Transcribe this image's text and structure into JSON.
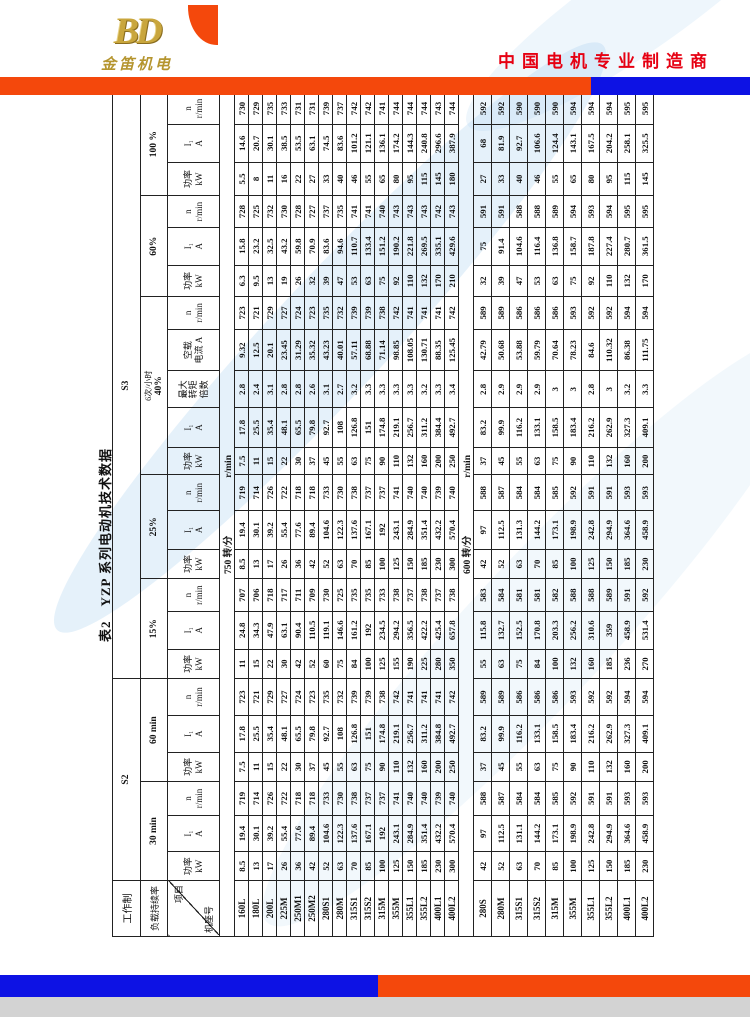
{
  "header": {
    "logo_monogram": "BD",
    "logo_text": "金笛机电",
    "slogan": "中国电机专业制造商"
  },
  "title": "表2　YZP 系列电动机技术数据",
  "table": {
    "work_system_label": "工作制",
    "duty_rate_label": "负载持续率",
    "corner": {
      "top": "项目",
      "bottom": "机座号"
    },
    "s2_label": "S2",
    "s3_label": "S3",
    "groups": [
      {
        "duty": [
          "30 min"
        ],
        "cols": [
          [
            "功率",
            "kW"
          ],
          [
            "I₁",
            "A"
          ],
          [
            "n",
            "r/min"
          ]
        ]
      },
      {
        "duty": [
          "60 min"
        ],
        "cols": [
          [
            "功率",
            "kW"
          ],
          [
            "I₁",
            "A"
          ],
          [
            "n",
            "r/min"
          ]
        ]
      },
      {
        "duty": [
          "15%"
        ],
        "cols": [
          [
            "功率",
            "kW"
          ],
          [
            "I₁",
            "A"
          ],
          [
            "n",
            "r/min"
          ]
        ]
      },
      {
        "duty": [
          "25%"
        ],
        "cols": [
          [
            "功率",
            "kW"
          ],
          [
            "I₁",
            "A"
          ],
          [
            "n",
            "r/min"
          ]
        ]
      },
      {
        "duty": [
          "6次/小时",
          "40%"
        ],
        "cols": [
          [
            "功率",
            "kW"
          ],
          [
            "I₁",
            "A"
          ],
          [
            "最大",
            "转矩",
            "倍数"
          ],
          [
            "空载",
            "电流 A"
          ],
          [
            "n",
            "r/min"
          ]
        ]
      },
      {
        "duty": [
          "60%"
        ],
        "cols": [
          [
            "功率",
            "kW"
          ],
          [
            "I₁",
            "A"
          ],
          [
            "n",
            "r/min"
          ]
        ]
      },
      {
        "duty": [
          "100 %"
        ],
        "cols": [
          [
            "功率",
            "kW"
          ],
          [
            "I₁",
            "A"
          ],
          [
            "n",
            "r/min"
          ]
        ]
      }
    ],
    "sections": [
      {
        "speed_label": "750 转/分",
        "unit": "r/min",
        "rows": [
          {
            "model": "160L",
            "v": [
              "8.5",
              "19.4",
              "719",
              "7.5",
              "17.8",
              "723",
              "11",
              "24.8",
              "707",
              "8.5",
              "19.4",
              "719",
              "7.5",
              "17.8",
              "2.8",
              "9.32",
              "723",
              "6.3",
              "15.8",
              "728",
              "5.5",
              "14.6",
              "730"
            ]
          },
          {
            "model": "180L",
            "v": [
              "13",
              "30.1",
              "714",
              "11",
              "25.5",
              "721",
              "15",
              "34.3",
              "706",
              "13",
              "30.1",
              "714",
              "11",
              "25.5",
              "2.4",
              "12.5",
              "721",
              "9.5",
              "23.2",
              "725",
              "8",
              "20.7",
              "729"
            ]
          },
          {
            "model": "200L",
            "v": [
              "17",
              "39.2",
              "726",
              "15",
              "35.4",
              "729",
              "22",
              "47.9",
              "718",
              "17",
              "39.2",
              "726",
              "15",
              "35.4",
              "3.1",
              "20.1",
              "729",
              "13",
              "32.5",
              "732",
              "11",
              "30.1",
              "735"
            ]
          },
          {
            "model": "225M",
            "v": [
              "26",
              "55.4",
              "722",
              "22",
              "48.1",
              "727",
              "30",
              "63.1",
              "717",
              "26",
              "55.4",
              "722",
              "22",
              "48.1",
              "2.8",
              "23.45",
              "727",
              "19",
              "43.2",
              "730",
              "16",
              "38.5",
              "733"
            ]
          },
          {
            "model": "250M1",
            "v": [
              "36",
              "77.6",
              "718",
              "30",
              "65.5",
              "724",
              "42",
              "90.4",
              "711",
              "36",
              "77.6",
              "718",
              "30",
              "65.5",
              "2.8",
              "31.29",
              "724",
              "26",
              "59.8",
              "728",
              "22",
              "53.5",
              "731"
            ]
          },
          {
            "model": "250M2",
            "v": [
              "42",
              "89.4",
              "718",
              "37",
              "79.8",
              "723",
              "52",
              "110.5",
              "709",
              "42",
              "89.4",
              "718",
              "37",
              "79.8",
              "2.6",
              "35.32",
              "723",
              "32",
              "70.9",
              "727",
              "27",
              "63.1",
              "731"
            ]
          },
          {
            "model": "280S1",
            "v": [
              "52",
              "104.6",
              "733",
              "45",
              "92.7",
              "735",
              "60",
              "119.1",
              "730",
              "52",
              "104.6",
              "733",
              "45",
              "92.7",
              "3.1",
              "43.23",
              "735",
              "39",
              "83.6",
              "737",
              "33",
              "74.5",
              "739"
            ]
          },
          {
            "model": "280M",
            "v": [
              "63",
              "122.3",
              "730",
              "55",
              "108",
              "732",
              "75",
              "146.6",
              "725",
              "63",
              "122.3",
              "730",
              "55",
              "108",
              "2.7",
              "40.01",
              "732",
              "47",
              "94.6",
              "735",
              "40",
              "83.6",
              "737"
            ]
          },
          {
            "model": "315S1",
            "v": [
              "70",
              "137.6",
              "738",
              "63",
              "126.8",
              "739",
              "84",
              "161.2",
              "735",
              "70",
              "137.6",
              "738",
              "63",
              "126.8",
              "3.2",
              "57.11",
              "739",
              "53",
              "110.7",
              "741",
              "46",
              "101.2",
              "742"
            ]
          },
          {
            "model": "315S2",
            "v": [
              "85",
              "167.1",
              "737",
              "75",
              "151",
              "739",
              "100",
              "192",
              "735",
              "85",
              "167.1",
              "737",
              "75",
              "151",
              "3.3",
              "68.88",
              "739",
              "63",
              "133.4",
              "741",
              "55",
              "121.1",
              "742"
            ]
          },
          {
            "model": "315M",
            "v": [
              "100",
              "192",
              "737",
              "90",
              "174.8",
              "738",
              "125",
              "234.5",
              "733",
              "100",
              "192",
              "737",
              "90",
              "174.8",
              "3.3",
              "71.14",
              "738",
              "75",
              "151.2",
              "740",
              "65",
              "136.1",
              "741"
            ]
          },
          {
            "model": "355M",
            "v": [
              "125",
              "243.1",
              "741",
              "110",
              "219.1",
              "742",
              "155",
              "294.2",
              "738",
              "125",
              "243.1",
              "741",
              "110",
              "219.1",
              "3.3",
              "98.85",
              "742",
              "92",
              "190.2",
              "743",
              "80",
              "174.2",
              "744"
            ]
          },
          {
            "model": "355L1",
            "v": [
              "150",
              "284.9",
              "740",
              "132",
              "256.7",
              "741",
              "190",
              "356.5",
              "737",
              "150",
              "284.9",
              "740",
              "132",
              "256.7",
              "3.3",
              "108.05",
              "741",
              "110",
              "221.8",
              "743",
              "95",
              "144.3",
              "744"
            ]
          },
          {
            "model": "355L2",
            "v": [
              "185",
              "351.4",
              "740",
              "160",
              "311.2",
              "741",
              "225",
              "422.2",
              "738",
              "185",
              "351.4",
              "740",
              "160",
              "311.2",
              "3.2",
              "130.71",
              "741",
              "132",
              "269.5",
              "743",
              "115",
              "240.8",
              "744"
            ]
          },
          {
            "model": "400L1",
            "v": [
              "230",
              "432.2",
              "739",
              "200",
              "384.8",
              "741",
              "280",
              "425.4",
              "737",
              "230",
              "432.2",
              "739",
              "200",
              "384.4",
              "3.3",
              "88.35",
              "741",
              "170",
              "335.1",
              "742",
              "145",
              "296.6",
              "743"
            ]
          },
          {
            "model": "400L2",
            "v": [
              "300",
              "570.4",
              "740",
              "250",
              "492.7",
              "742",
              "350",
              "657.8",
              "738",
              "300",
              "570.4",
              "740",
              "250",
              "492.7",
              "3.4",
              "125.45",
              "742",
              "210",
              "429.6",
              "743",
              "180",
              "387.9",
              "744"
            ]
          }
        ]
      },
      {
        "speed_label": "600 转/分",
        "unit": "r/min",
        "rows": [
          {
            "model": "280S",
            "v": [
              "42",
              "97",
              "588",
              "37",
              "83.2",
              "589",
              "55",
              "115.8",
              "583",
              "42",
              "97",
              "588",
              "37",
              "83.2",
              "2.8",
              "42.79",
              "589",
              "32",
              "75",
              "591",
              "27",
              "68",
              "592"
            ]
          },
          {
            "model": "280M",
            "v": [
              "52",
              "112.5",
              "587",
              "45",
              "99.9",
              "589",
              "63",
              "132.7",
              "584",
              "52",
              "112.5",
              "587",
              "45",
              "99.9",
              "2.9",
              "50.68",
              "589",
              "39",
              "91.4",
              "591",
              "33",
              "81.9",
              "592"
            ]
          },
          {
            "model": "315S1",
            "v": [
              "63",
              "131.1",
              "584",
              "55",
              "116.2",
              "586",
              "75",
              "152.5",
              "581",
              "63",
              "131.3",
              "584",
              "55",
              "116.2",
              "2.9",
              "53.88",
              "586",
              "47",
              "104.6",
              "588",
              "40",
              "92.7",
              "590"
            ]
          },
          {
            "model": "315S2",
            "v": [
              "70",
              "144.2",
              "584",
              "63",
              "133.1",
              "586",
              "84",
              "170.8",
              "581",
              "70",
              "144.2",
              "584",
              "63",
              "133.1",
              "2.9",
              "59.79",
              "586",
              "53",
              "116.4",
              "588",
              "46",
              "106.6",
              "590"
            ]
          },
          {
            "model": "315M",
            "v": [
              "85",
              "173.1",
              "585",
              "75",
              "158.5",
              "586",
              "100",
              "203.3",
              "582",
              "85",
              "173.1",
              "585",
              "75",
              "158.5",
              "3",
              "70.64",
              "586",
              "63",
              "136.8",
              "589",
              "55",
              "124.4",
              "590"
            ]
          },
          {
            "model": "355M",
            "v": [
              "100",
              "198.9",
              "592",
              "90",
              "183.4",
              "593",
              "132",
              "256.2",
              "588",
              "100",
              "198.9",
              "592",
              "90",
              "183.4",
              "3",
              "78.23",
              "593",
              "75",
              "158.7",
              "594",
              "65",
              "143.1",
              "594"
            ]
          },
          {
            "model": "355L1",
            "v": [
              "125",
              "242.8",
              "591",
              "110",
              "216.2",
              "592",
              "160",
              "310.6",
              "588",
              "125",
              "242.8",
              "591",
              "110",
              "216.2",
              "2.8",
              "84.6",
              "592",
              "92",
              "187.8",
              "593",
              "80",
              "167.5",
              "594"
            ]
          },
          {
            "model": "355L2",
            "v": [
              "150",
              "294.9",
              "591",
              "132",
              "262.9",
              "592",
              "185",
              "359",
              "589",
              "150",
              "294.9",
              "591",
              "132",
              "262.9",
              "3",
              "110.32",
              "592",
              "110",
              "227.4",
              "594",
              "95",
              "204.2",
              "594"
            ]
          },
          {
            "model": "400L1",
            "v": [
              "185",
              "364.6",
              "593",
              "160",
              "327.3",
              "594",
              "236",
              "458.9",
              "591",
              "185",
              "364.6",
              "593",
              "160",
              "327.3",
              "3.2",
              "86.38",
              "594",
              "132",
              "280.7",
              "595",
              "115",
              "258.1",
              "595"
            ]
          },
          {
            "model": "400L2",
            "v": [
              "230",
              "458.9",
              "593",
              "200",
              "409.1",
              "594",
              "270",
              "531.4",
              "592",
              "230",
              "458.9",
              "593",
              "200",
              "409.1",
              "3.3",
              "111.75",
              "594",
              "170",
              "361.5",
              "595",
              "145",
              "325.5",
              "595"
            ]
          }
        ]
      }
    ]
  },
  "colors": {
    "accent_orange": "#f4480c",
    "accent_blue": "#0d12e4",
    "slogan_red": "#e60012",
    "logo_gold": "#c9a63d"
  }
}
